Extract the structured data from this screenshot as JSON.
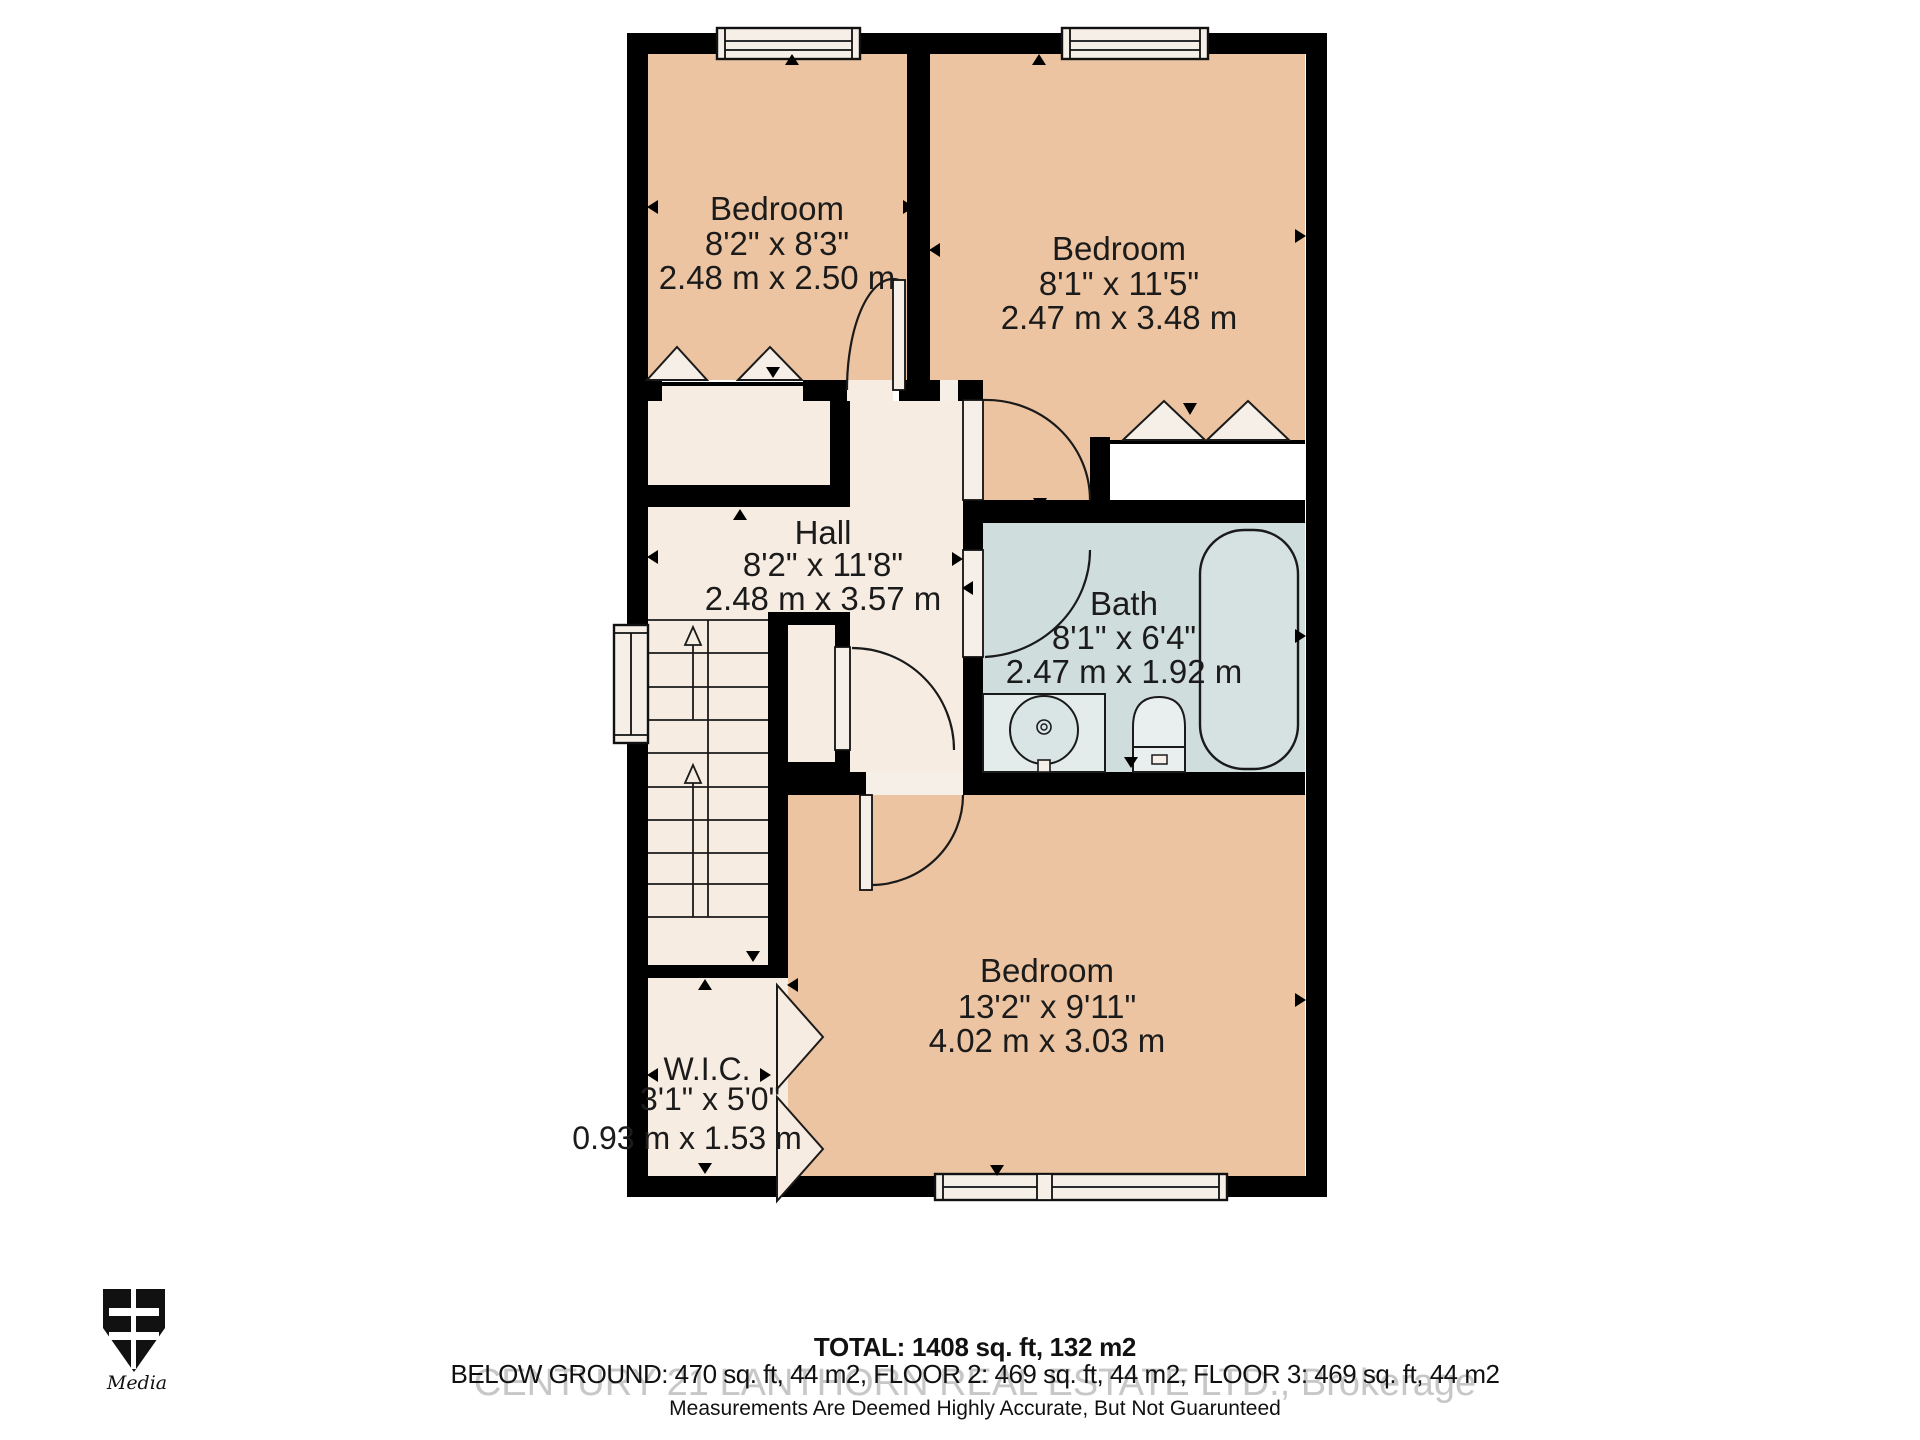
{
  "colors": {
    "wall": "#000000",
    "bedroom_fill": "#ecc4a1",
    "hall_fill": "#f7ece2",
    "bath_fill": "#cfdddc",
    "white_fixture": "#f5efe8",
    "text": "#1b1b1b",
    "watermark": "#c7c7c7"
  },
  "rooms": {
    "bedroom1": {
      "label": "Bedroom",
      "imperial": "8'2\" x 8'3\"",
      "metric": "2.48 m x 2.50 m"
    },
    "bedroom2": {
      "label": "Bedroom",
      "imperial": "8'1\" x 11'5\"",
      "metric": "2.47 m x 3.48 m"
    },
    "hall": {
      "label": "Hall",
      "imperial": "8'2\" x 11'8\"",
      "metric": "2.48 m x 3.57 m"
    },
    "bath": {
      "label": "Bath",
      "imperial": "8'1\" x 6'4\"",
      "metric": "2.47 m x 1.92 m"
    },
    "bedroom3": {
      "label": "Bedroom",
      "imperial": "13'2\" x 9'11\"",
      "metric": "4.02 m x 3.03 m"
    },
    "wic": {
      "label": "W.I.C.",
      "imperial": "3'1\" x 5'0\"",
      "metric": "0.93 m x 1.53 m"
    }
  },
  "footer": {
    "total": "TOTAL: 1408 sq. ft, 132 m2",
    "floors": "BELOW GROUND: 470 sq. ft, 44 m2, FLOOR 2: 469 sq. ft, 44 m2, FLOOR 3: 469 sq. ft, 44 m2",
    "watermark": "CENTURY 21 LANTHORN REAL ESTATE LTD., Brokerage",
    "disclaimer": "Measurements Are Deemed Highly Accurate, But Not Guarunteed"
  },
  "logo": {
    "initials": "BE",
    "subtext": "Media"
  }
}
